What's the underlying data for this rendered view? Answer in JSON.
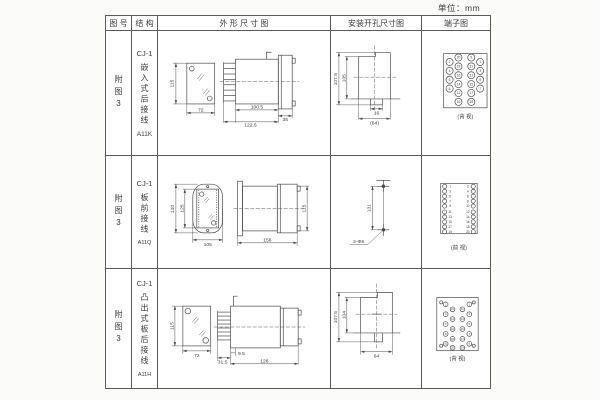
{
  "unit_label": "单位：mm",
  "table": {
    "headers": {
      "figure_no": "图 号",
      "structure": "结 构",
      "outline": "外 形 尺 寸 图",
      "install": "安装开孔尺寸图",
      "terminal": "端子图"
    },
    "rows": [
      {
        "figure_no": "附图3",
        "structure": {
          "model": "CJ-1",
          "desc": "嵌入式后接线",
          "code": "A11K"
        },
        "outline": {
          "front_h": "115",
          "front_w": "72",
          "body_len": "100.5",
          "flange_w": "35",
          "total_len": "122.5"
        },
        "install": {
          "outer_h": "107.5",
          "inner_h": "105",
          "slot_w": "16",
          "base_w": "(64)"
        },
        "terminal": {
          "view_label": "(背 视)",
          "pins": [
            {
              "n": "20",
              "x": 37,
              "y": 26
            },
            {
              "n": "18",
              "x": 37,
              "y": 35
            },
            {
              "n": "16",
              "x": 37,
              "y": 44
            },
            {
              "n": "14",
              "x": 37,
              "y": 53
            },
            {
              "n": "12",
              "x": 37,
              "y": 62
            },
            {
              "n": "10",
              "x": 37,
              "y": 71
            },
            {
              "n": "9",
              "x": 50,
              "y": 26
            },
            {
              "n": "11",
              "x": 50,
              "y": 35
            },
            {
              "n": "13",
              "x": 50,
              "y": 44
            },
            {
              "n": "15",
              "x": 50,
              "y": 53
            },
            {
              "n": "17",
              "x": 50,
              "y": 62
            },
            {
              "n": "19",
              "x": 50,
              "y": 71
            },
            {
              "n": "2",
              "x": 28,
              "y": 30.5
            },
            {
              "n": "4",
              "x": 28,
              "y": 39.5
            },
            {
              "n": "6",
              "x": 28,
              "y": 48.5
            },
            {
              "n": "8",
              "x": 28,
              "y": 57.5
            },
            {
              "n": "1",
              "x": 59,
              "y": 30.5
            },
            {
              "n": "3",
              "x": 59,
              "y": 39.5
            },
            {
              "n": "5",
              "x": 59,
              "y": 48.5
            },
            {
              "n": "7",
              "x": 59,
              "y": 57.5
            }
          ]
        }
      },
      {
        "figure_no": "附图3",
        "structure": {
          "model": "CJ-1",
          "desc": "板前接线",
          "code": "A11Q"
        },
        "outline": {
          "front_h": "140",
          "inner_h": "125",
          "front_w": "105",
          "body_len": "156",
          "side_h": "115"
        },
        "install": {
          "hole_spacing": "131",
          "holes_label": "2-Φ6"
        },
        "terminal": {
          "view_label": "(前 视)",
          "pins": [
            {
              "n": "1",
              "x": 23,
              "y": 30,
              "nx": 28.5
            },
            {
              "n": "3",
              "x": 23,
              "y": 35,
              "nx": 28.5
            },
            {
              "n": "5",
              "x": 23,
              "y": 40,
              "nx": 28.5
            },
            {
              "n": "7",
              "x": 23,
              "y": 45,
              "nx": 28.5
            },
            {
              "n": "9",
              "x": 23,
              "y": 50,
              "nx": 28.5
            },
            {
              "n": "11",
              "x": 23,
              "y": 56,
              "nx": 28.5
            },
            {
              "n": "13",
              "x": 23,
              "y": 61,
              "nx": 28.5
            },
            {
              "n": "15",
              "x": 23,
              "y": 66,
              "nx": 28.5
            },
            {
              "n": "17",
              "x": 23,
              "y": 71,
              "nx": 28.5
            },
            {
              "n": "19",
              "x": 23,
              "y": 76,
              "nx": 28.5
            },
            {
              "n": "2",
              "x": 52,
              "y": 30,
              "nx": 46.5
            },
            {
              "n": "4",
              "x": 52,
              "y": 35,
              "nx": 46.5
            },
            {
              "n": "6",
              "x": 52,
              "y": 40,
              "nx": 46.5
            },
            {
              "n": "8",
              "x": 52,
              "y": 45,
              "nx": 46.5
            },
            {
              "n": "10",
              "x": 52,
              "y": 50,
              "nx": 46.5
            },
            {
              "n": "12",
              "x": 52,
              "y": 56,
              "nx": 46.5
            },
            {
              "n": "14",
              "x": 52,
              "y": 61,
              "nx": 46.5
            },
            {
              "n": "16",
              "x": 52,
              "y": 66,
              "nx": 46.5
            },
            {
              "n": "18",
              "x": 52,
              "y": 71,
              "nx": 46.5
            },
            {
              "n": "20",
              "x": 52,
              "y": 76,
              "nx": 46.5
            }
          ]
        }
      },
      {
        "figure_no": "附图3",
        "structure": {
          "model": "CJ-1",
          "desc": "凸出式板后接线",
          "code": "A11H"
        },
        "outline": {
          "front_h": "115",
          "front_w": "72",
          "pin_len": "31.5",
          "gap": "9.5",
          "body_len": "126"
        },
        "install": {
          "outer_h": "107.5",
          "inner_h": "104",
          "base_w": "64"
        },
        "terminal": {
          "view_label": "(背 视)",
          "pins": [
            {
              "x": 19.5,
              "y": 33,
              "r": 1.6
            },
            {
              "x": 52.5,
              "y": 33,
              "r": 1.6
            },
            {
              "x": 19.5,
              "y": 77,
              "r": 1.6
            },
            {
              "x": 52.5,
              "y": 77,
              "r": 1.6
            },
            {
              "n": "2",
              "x": 24,
              "y": 35
            },
            {
              "n": "4",
              "x": 24,
              "y": 45
            },
            {
              "n": "6",
              "x": 24,
              "y": 55
            },
            {
              "n": "8",
              "x": 24,
              "y": 65
            },
            {
              "n": "10",
              "x": 24,
              "y": 75
            },
            {
              "n": "12",
              "x": 31,
              "y": 40
            },
            {
              "n": "14",
              "x": 31,
              "y": 50
            },
            {
              "n": "16",
              "x": 31,
              "y": 60
            },
            {
              "n": "18",
              "x": 31,
              "y": 70
            },
            {
              "n": "20",
              "x": 31,
              "y": 79
            },
            {
              "n": "11",
              "x": 41,
              "y": 40
            },
            {
              "n": "13",
              "x": 41,
              "y": 50
            },
            {
              "n": "15",
              "x": 41,
              "y": 60
            },
            {
              "n": "17",
              "x": 41,
              "y": 70
            },
            {
              "n": "19",
              "x": 41,
              "y": 79
            },
            {
              "n": "1",
              "x": 48,
              "y": 35
            },
            {
              "n": "3",
              "x": 48,
              "y": 45
            },
            {
              "n": "5",
              "x": 48,
              "y": 55
            },
            {
              "n": "7",
              "x": 48,
              "y": 65
            },
            {
              "n": "9",
              "x": 48,
              "y": 75
            }
          ]
        }
      }
    ]
  }
}
